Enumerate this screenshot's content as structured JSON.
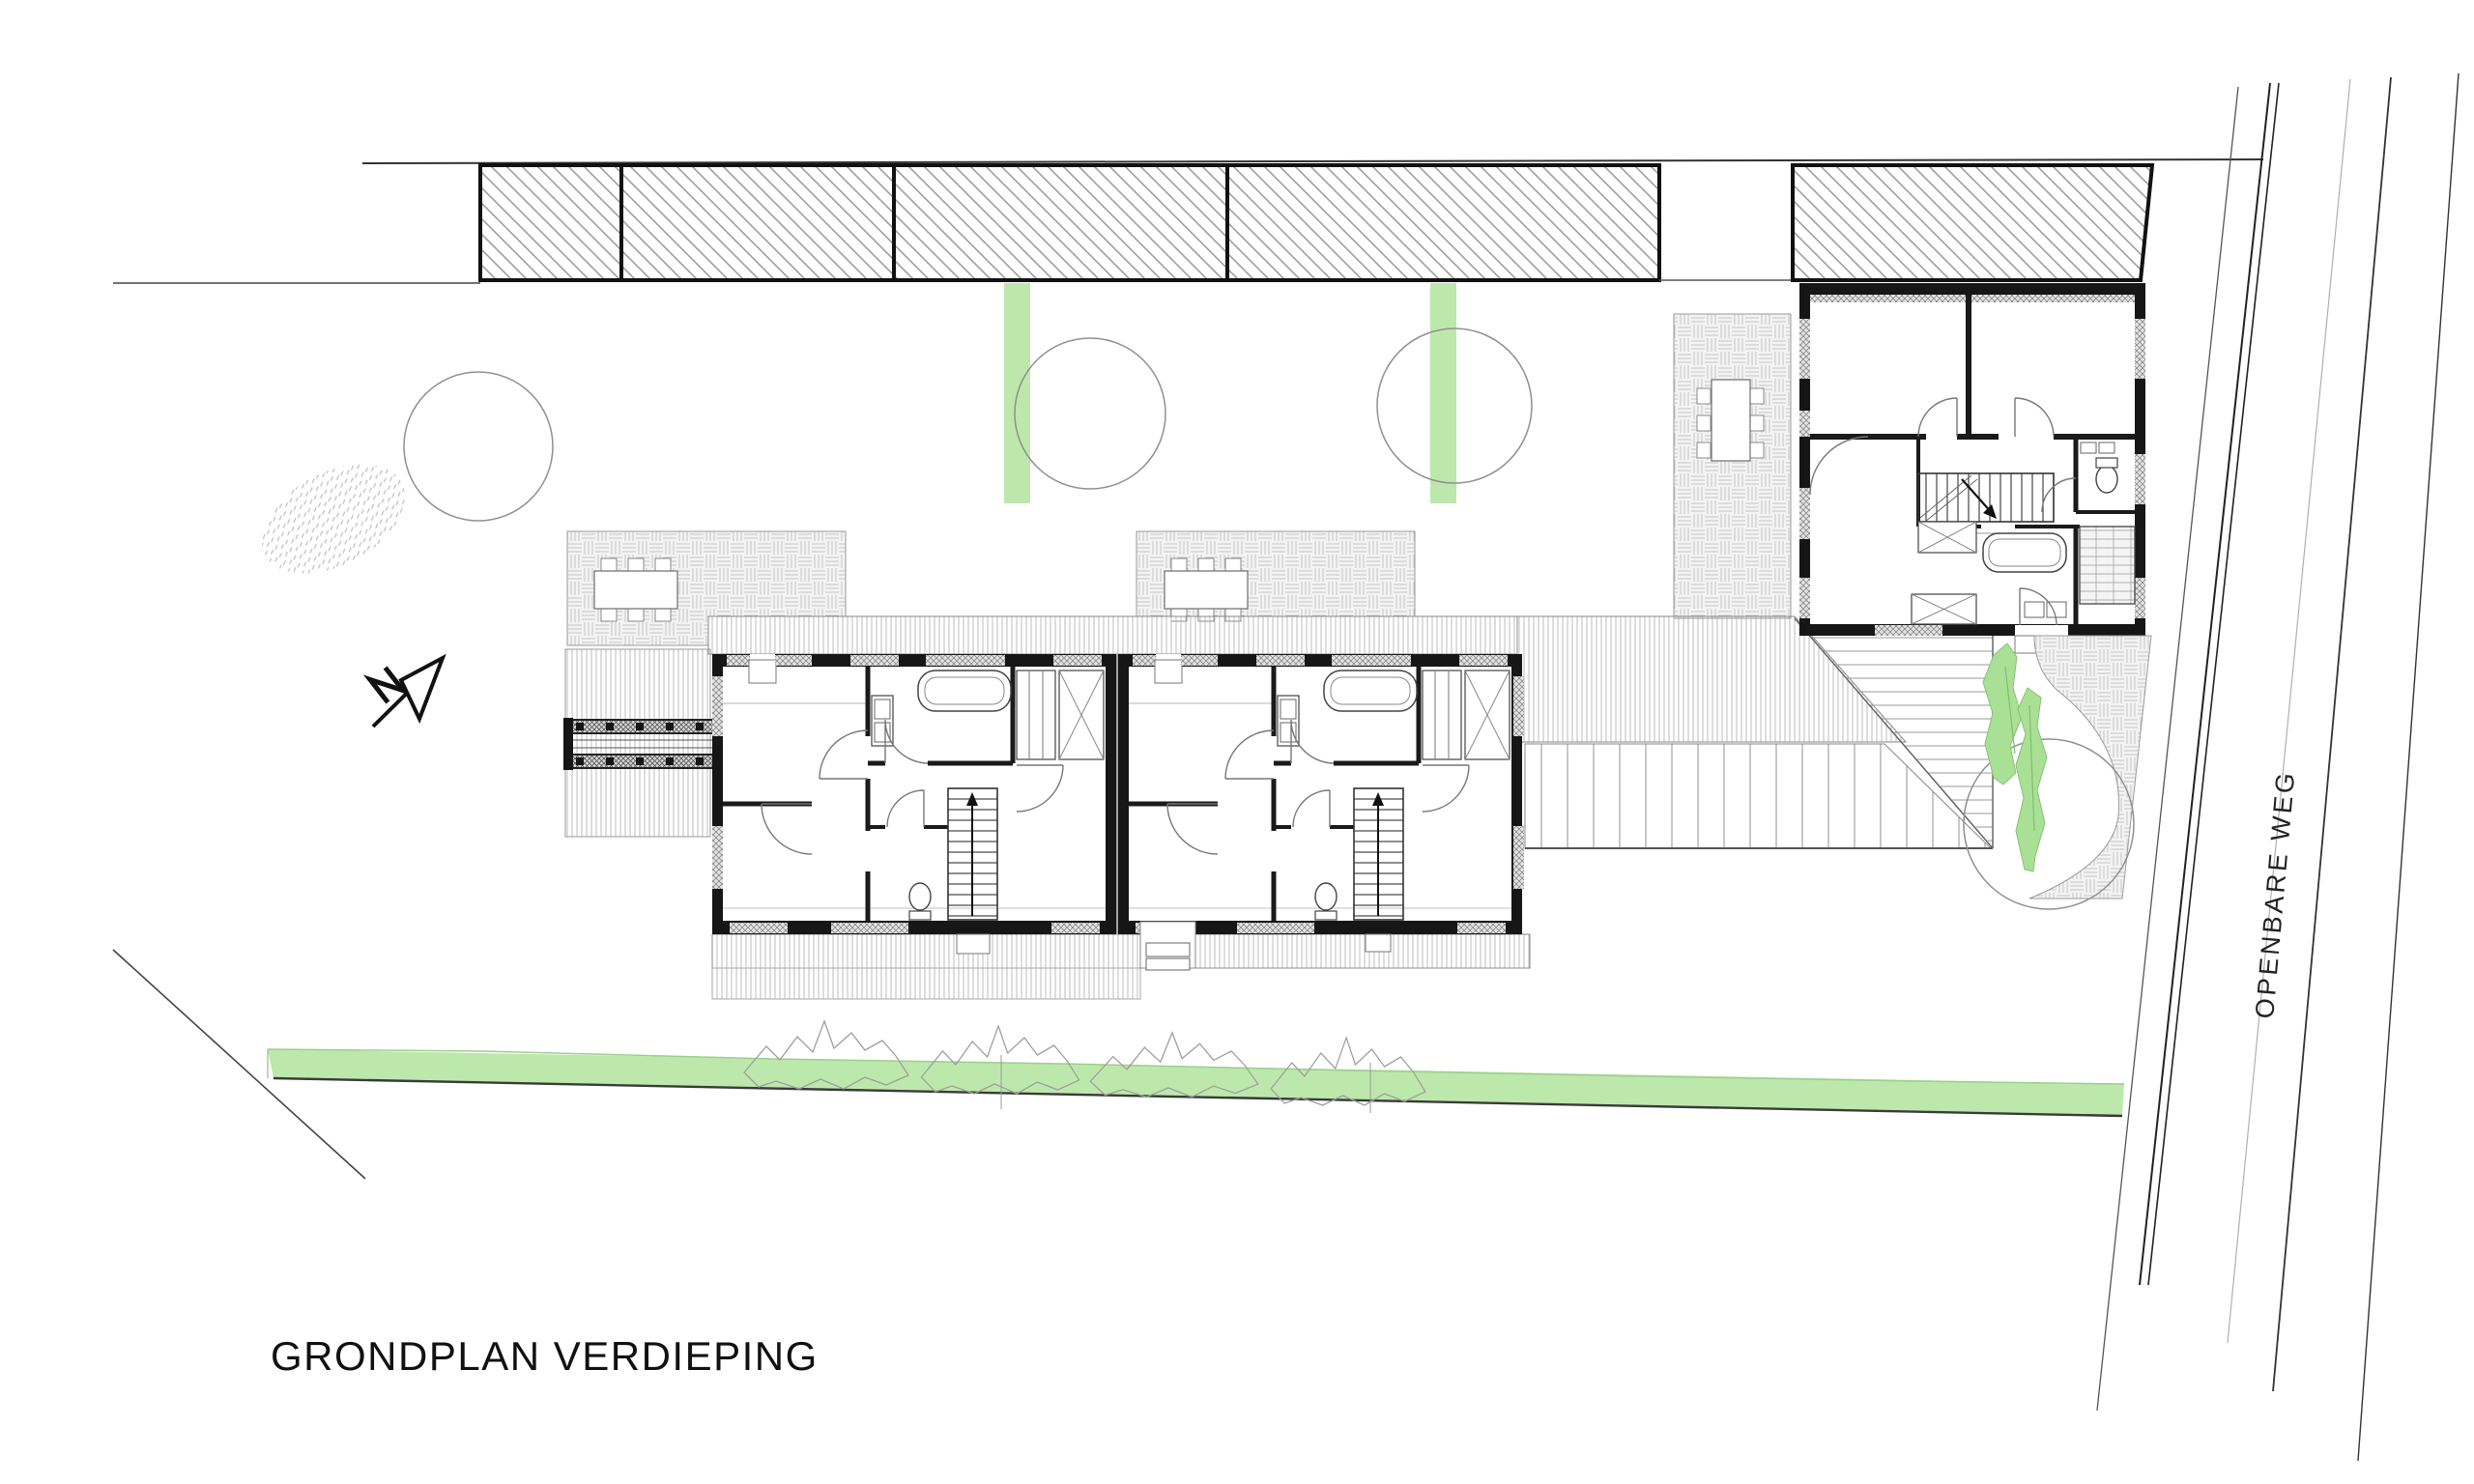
{
  "title": {
    "text": "GRONDPLAN VERDIEPING"
  },
  "road": {
    "label": "OPENBARE WEG"
  },
  "drawing": {
    "kind": "architectural-site-plan",
    "floor": "verdieping (upper floor)",
    "buildings": [
      {
        "name": "duplex-house-left",
        "features": [
          "bedrooms",
          "bathroom with bathtub",
          "wc",
          "staircase",
          "wardrobes",
          "entry bridge west"
        ]
      },
      {
        "name": "duplex-house-right",
        "features": [
          "bedrooms",
          "bathroom with bathtub",
          "wc",
          "staircase",
          "wardrobes",
          "south entrance"
        ]
      },
      {
        "name": "detached-house-northeast",
        "features": [
          "two north rooms",
          "staircase",
          "wc",
          "bathroom with bathtub",
          "shower",
          "wardrobes"
        ]
      },
      {
        "name": "existing-roofs-strip-north",
        "features": [
          "diagonal hatch",
          "four segments",
          "separate block near road"
        ]
      }
    ],
    "landscape": [
      {
        "name": "hedge-strip-south",
        "color": "#bde8ac"
      },
      {
        "name": "vertical-hedge-strips",
        "count": 2,
        "color": "#bde8ac"
      },
      {
        "name": "trees",
        "count": 4
      },
      {
        "name": "shrub-row-south",
        "count": 4
      },
      {
        "name": "planting-bed-ellipse-west",
        "texture": "dashed"
      },
      {
        "name": "terraces-basketweave",
        "count": 4
      },
      {
        "name": "timber-deck-bands",
        "texture": "fine vertical lines"
      },
      {
        "name": "leafy-bush-east",
        "color": "#a9e095"
      }
    ],
    "annotations": [
      {
        "name": "north-arrow"
      },
      {
        "name": "public-road-east",
        "label_ref": "road.label"
      }
    ],
    "colors": {
      "wall": "#1a1a1a",
      "hatch_gray": "#9f9f9f",
      "paving_gray": "#c4c4c4",
      "deck_gray": "#b5b5b5",
      "green": "#bde8ac",
      "leaf_green": "#a9e095",
      "line_dark": "#333333"
    }
  }
}
